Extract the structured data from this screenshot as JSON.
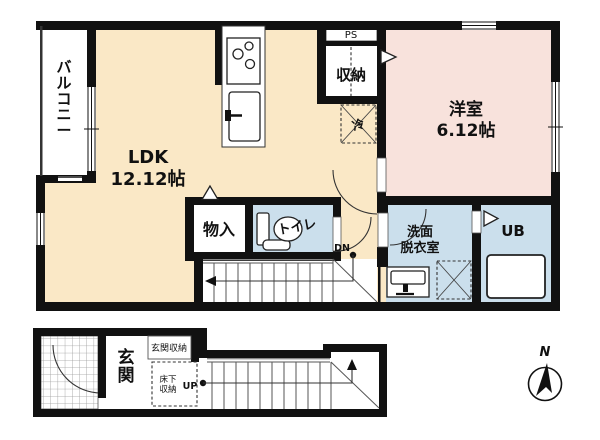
{
  "floor2": {
    "balcony_label": "バルコニー",
    "ldk": {
      "name": "LDK",
      "area": "12.12帖"
    },
    "ps_label": "PS",
    "closet_label": "収納",
    "fridge_label": "冷",
    "western_room": {
      "name": "洋室",
      "area": "6.12帖"
    },
    "storage_label": "物入",
    "toilet_label": "トイレ",
    "stairs_down_label": "DN",
    "washroom": {
      "line1": "洗面",
      "line2": "脱衣室"
    },
    "unit_bath_label": "UB"
  },
  "floor1": {
    "entrance_label": "玄関",
    "entrance_storage_label": "玄関収納",
    "underfloor_storage": {
      "line1": "床下",
      "line2": "収納"
    },
    "stairs_up_label": "UP"
  },
  "compass": {
    "north_label": "N"
  },
  "colors": {
    "wall": "#111111",
    "ldk": "#FAE8C6",
    "western_room": "#F8E2DC",
    "wet_area": "#CBDFEC",
    "white": "#FFFFFF"
  }
}
